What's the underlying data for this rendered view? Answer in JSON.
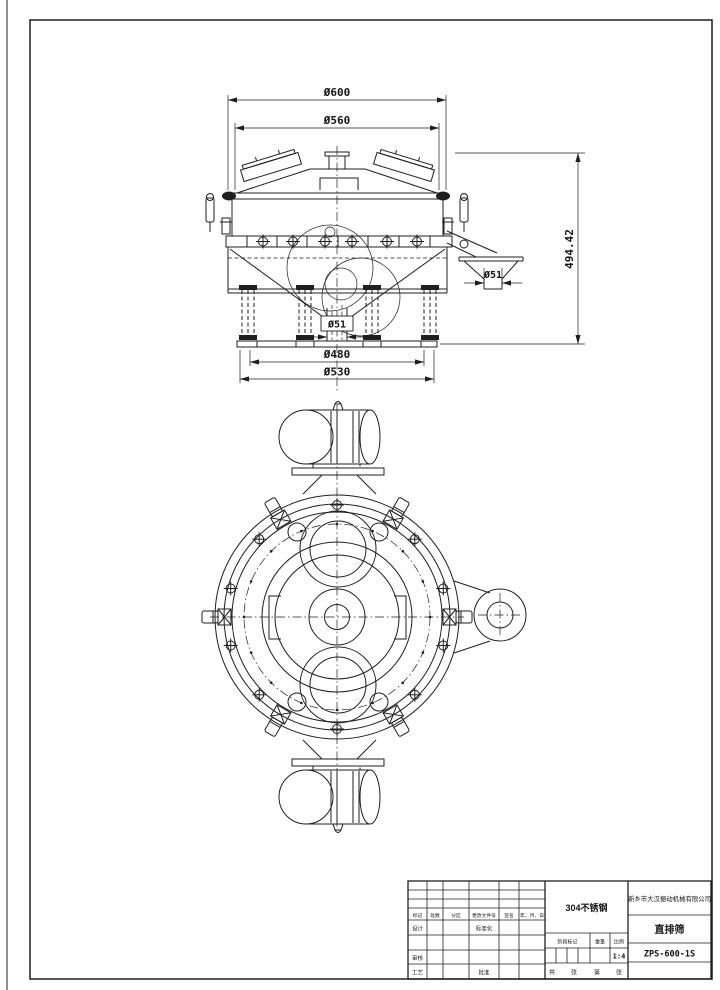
{
  "sheet": {
    "type": "engineering-drawing",
    "line_color": "#1f1f1f",
    "paper_color": "#ffffff"
  },
  "drawing": {
    "dims": {
      "top_outer": "Ø600",
      "top_inner": "Ø560",
      "overall_height": "494.42",
      "side_outlet": "Ø51",
      "center_outlet": "Ø51",
      "base_inner": "Ø480",
      "base_outer": "Ø530"
    }
  },
  "title_block": {
    "material": "304不锈钢",
    "company": "新乡市大汉振动机械有限公司",
    "product": "直排筛",
    "drawing_no": "ZPS-600-1S",
    "scale_value": "1:4",
    "col_headers": [
      "标记",
      "处数",
      "分区",
      "更改文件号",
      "签名",
      "年、月、日"
    ],
    "row_labels": {
      "design": "设计",
      "standardize": "标准化",
      "check": "审核",
      "craft": "工艺",
      "approve": "批准"
    },
    "info_labels": {
      "stage": "阶段标记",
      "weight": "重量",
      "scale": "比例"
    },
    "sheet_labels": {
      "total": "共",
      "sheets": "张",
      "no": "第",
      "sheets2": "张"
    }
  }
}
